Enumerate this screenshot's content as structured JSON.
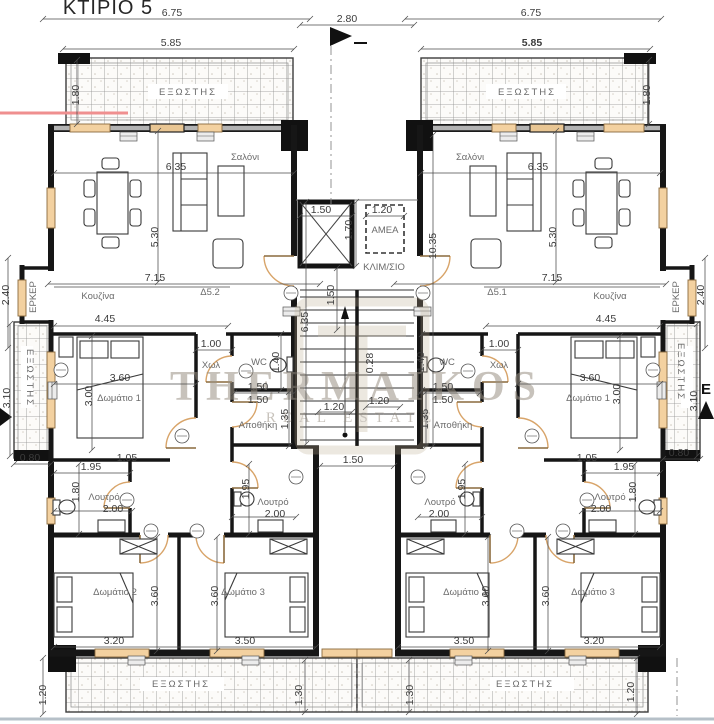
{
  "title": "ΚΤΙΡΙΟ 5",
  "watermark": {
    "name": "THERMAIKOS",
    "tagline": "REAL ESTATE"
  },
  "colors": {
    "wall": "#161616",
    "window": "#f3d1a0",
    "door_arc": "#d8a469",
    "hatch_line": "#8f8f8f",
    "watermark": "#9a9184",
    "red_line": "#ef8f8f",
    "dim_text": "#3c3c3c",
    "room_text": "#6b6b6b"
  },
  "labels": [
    {
      "t": "ΚΤΙΡΙΟ 5",
      "x": 108,
      "y": 14,
      "k": "t"
    },
    {
      "t": "6.75",
      "x": 172,
      "y": 16,
      "k": "d"
    },
    {
      "t": "2.80",
      "x": 347,
      "y": 22,
      "k": "d"
    },
    {
      "t": "6.75",
      "x": 531,
      "y": 16,
      "k": "d"
    },
    {
      "t": "5.85",
      "x": 171,
      "y": 46,
      "k": "d"
    },
    {
      "t": "5.85",
      "x": 532,
      "y": 46,
      "k": "d",
      "b": 1
    },
    {
      "t": "ΕΞΩΣΤΗΣ",
      "x": 188,
      "y": 95,
      "k": "r",
      "ls": 2
    },
    {
      "t": "ΕΞΩΣΤΗΣ",
      "x": 527,
      "y": 95,
      "k": "r",
      "ls": 2
    },
    {
      "t": "1.80",
      "x": 79,
      "y": 95,
      "k": "d",
      "r": -90
    },
    {
      "t": "1.80",
      "x": 650,
      "y": 95,
      "k": "d",
      "r": -90
    },
    {
      "t": "Σαλόνι",
      "x": 245,
      "y": 160,
      "k": "r"
    },
    {
      "t": "Σαλόνι",
      "x": 470,
      "y": 160,
      "k": "r"
    },
    {
      "t": "6.35",
      "x": 176,
      "y": 170,
      "k": "d"
    },
    {
      "t": "6.35",
      "x": 538,
      "y": 170,
      "k": "d"
    },
    {
      "t": "5.30",
      "x": 158,
      "y": 237,
      "k": "d",
      "r": -90
    },
    {
      "t": "5.30",
      "x": 556,
      "y": 237,
      "k": "d",
      "r": -90
    },
    {
      "t": "1.50",
      "x": 321,
      "y": 213,
      "k": "d"
    },
    {
      "t": "1.70",
      "x": 352,
      "y": 230,
      "k": "d",
      "r": -90
    },
    {
      "t": "1.20",
      "x": 382,
      "y": 213,
      "k": "d"
    },
    {
      "t": "ΑΜΕΑ",
      "x": 385,
      "y": 233,
      "k": "r",
      "s": 9
    },
    {
      "t": "ΚΛΙΜ/ΣΙΟ",
      "x": 384,
      "y": 270,
      "k": "r",
      "s": 9
    },
    {
      "t": "10.35",
      "x": 436,
      "y": 246,
      "k": "d",
      "r": -90
    },
    {
      "t": "6.35",
      "x": 308,
      "y": 322,
      "k": "d",
      "r": -90
    },
    {
      "t": "1.50",
      "x": 334,
      "y": 295,
      "k": "d",
      "r": -90
    },
    {
      "t": "0.28",
      "x": 373,
      "y": 363,
      "k": "d",
      "r": -90
    },
    {
      "t": "7.15",
      "x": 155,
      "y": 281,
      "k": "d"
    },
    {
      "t": "7.15",
      "x": 552,
      "y": 281,
      "k": "d"
    },
    {
      "t": "Κουζίνα",
      "x": 98,
      "y": 299,
      "k": "r"
    },
    {
      "t": "Κουζίνα",
      "x": 610,
      "y": 299,
      "k": "r"
    },
    {
      "t": "Δ5.2",
      "x": 210,
      "y": 295,
      "k": "r"
    },
    {
      "t": "Δ5.1",
      "x": 497,
      "y": 295,
      "k": "r"
    },
    {
      "t": "ΕΡΚΕΡ",
      "x": 36,
      "y": 297,
      "k": "r",
      "r": -90,
      "s": 9
    },
    {
      "t": "ΕΡΚΕΡ",
      "x": 679,
      "y": 297,
      "k": "r",
      "r": -90,
      "s": 9
    },
    {
      "t": "2.40",
      "x": 9,
      "y": 295,
      "k": "d",
      "r": -90
    },
    {
      "t": "2.40",
      "x": 704,
      "y": 295,
      "k": "d",
      "r": -90
    },
    {
      "t": "4.45",
      "x": 105,
      "y": 322,
      "k": "d"
    },
    {
      "t": "4.45",
      "x": 606,
      "y": 322,
      "k": "d"
    },
    {
      "t": "1.00",
      "x": 211,
      "y": 347,
      "k": "d"
    },
    {
      "t": "1.00",
      "x": 499,
      "y": 347,
      "k": "d"
    },
    {
      "t": "Χωλ",
      "x": 211,
      "y": 368,
      "k": "r"
    },
    {
      "t": "Χωλ",
      "x": 499,
      "y": 368,
      "k": "r"
    },
    {
      "t": "WC",
      "x": 259,
      "y": 365,
      "k": "r",
      "s": 9
    },
    {
      "t": "WC",
      "x": 447,
      "y": 365,
      "k": "r",
      "s": 9
    },
    {
      "t": "1.40",
      "x": 279,
      "y": 362,
      "k": "d",
      "r": -90
    },
    {
      "t": "1.40",
      "x": 424,
      "y": 362,
      "k": "d",
      "r": -90
    },
    {
      "t": "3.60",
      "x": 120,
      "y": 381,
      "k": "d"
    },
    {
      "t": "3.60",
      "x": 590,
      "y": 381,
      "k": "d"
    },
    {
      "t": "Δωμάτιο 1",
      "x": 119,
      "y": 401,
      "k": "r"
    },
    {
      "t": "Δωμάτιο 1",
      "x": 588,
      "y": 401,
      "k": "r"
    },
    {
      "t": "3.00",
      "x": 92,
      "y": 396,
      "k": "d",
      "r": -90
    },
    {
      "t": "3.00",
      "x": 620,
      "y": 394,
      "k": "d",
      "r": -90
    },
    {
      "t": "1.50",
      "x": 258,
      "y": 390,
      "k": "d"
    },
    {
      "t": "1.50",
      "x": 258,
      "y": 403,
      "k": "d"
    },
    {
      "t": "1.50",
      "x": 443,
      "y": 390,
      "k": "d"
    },
    {
      "t": "1.50",
      "x": 443,
      "y": 403,
      "k": "d"
    },
    {
      "t": "Αποθήκη",
      "x": 258,
      "y": 428,
      "k": "r",
      "s": 8.5
    },
    {
      "t": "Αποθήκη",
      "x": 453,
      "y": 428,
      "k": "r",
      "s": 8.5
    },
    {
      "t": "1.35",
      "x": 288,
      "y": 419,
      "k": "d",
      "r": -90
    },
    {
      "t": "1.35",
      "x": 428,
      "y": 419,
      "k": "d",
      "r": -90
    },
    {
      "t": "1.20",
      "x": 334,
      "y": 410,
      "k": "d"
    },
    {
      "t": "1.20",
      "x": 379,
      "y": 404,
      "k": "d"
    },
    {
      "t": "ΕΞΩΣΤΗΣ",
      "x": 27,
      "y": 378,
      "k": "r",
      "r": 90,
      "s": 8.5,
      "ls": 2
    },
    {
      "t": "ΕΞΩΣΤΗΣ",
      "x": 678,
      "y": 372,
      "k": "r",
      "r": 90,
      "s": 8.5,
      "ls": 2
    },
    {
      "t": "3.10",
      "x": 10,
      "y": 398,
      "k": "d",
      "r": -90
    },
    {
      "t": "3.10",
      "x": 697,
      "y": 401,
      "k": "d",
      "r": -90
    },
    {
      "t": "0.80",
      "x": 30,
      "y": 461,
      "k": "d"
    },
    {
      "t": "0.80",
      "x": 679,
      "y": 456,
      "k": "d"
    },
    {
      "t": "1.05",
      "x": 127,
      "y": 461,
      "k": "d"
    },
    {
      "t": "1.05",
      "x": 587,
      "y": 461,
      "k": "d"
    },
    {
      "t": "1.50",
      "x": 353,
      "y": 463,
      "k": "d"
    },
    {
      "t": "1.95",
      "x": 91,
      "y": 470,
      "k": "d"
    },
    {
      "t": "1.95",
      "x": 624,
      "y": 470,
      "k": "d"
    },
    {
      "t": "1.80",
      "x": 79,
      "y": 492,
      "k": "d",
      "r": -90
    },
    {
      "t": "1.80",
      "x": 636,
      "y": 492,
      "k": "d",
      "r": -90
    },
    {
      "t": "Λουτρό",
      "x": 104,
      "y": 500,
      "k": "r"
    },
    {
      "t": "Λουτρό",
      "x": 273,
      "y": 505,
      "k": "r"
    },
    {
      "t": "Λουτρό",
      "x": 440,
      "y": 505,
      "k": "r"
    },
    {
      "t": "Λουτρό",
      "x": 610,
      "y": 500,
      "k": "r"
    },
    {
      "t": "2.00",
      "x": 113,
      "y": 512,
      "k": "d"
    },
    {
      "t": "2.00",
      "x": 275,
      "y": 517,
      "k": "d"
    },
    {
      "t": "2.00",
      "x": 439,
      "y": 517,
      "k": "d"
    },
    {
      "t": "2.00",
      "x": 601,
      "y": 512,
      "k": "d"
    },
    {
      "t": "1.95",
      "x": 249,
      "y": 489,
      "k": "d",
      "r": -90
    },
    {
      "t": "1.95",
      "x": 465,
      "y": 489,
      "k": "d",
      "r": -90
    },
    {
      "t": "Δωμάτιο 2",
      "x": 115,
      "y": 595,
      "k": "r"
    },
    {
      "t": "3.60",
      "x": 158,
      "y": 596,
      "k": "d",
      "r": -90
    },
    {
      "t": "3.20",
      "x": 114,
      "y": 644,
      "k": "d"
    },
    {
      "t": "Δωμάτιο 3",
      "x": 243,
      "y": 595,
      "k": "r"
    },
    {
      "t": "3.60",
      "x": 218,
      "y": 596,
      "k": "d",
      "r": -90
    },
    {
      "t": "3.50",
      "x": 245,
      "y": 644,
      "k": "d"
    },
    {
      "t": "Δωμάτιο 2",
      "x": 465,
      "y": 595,
      "k": "r"
    },
    {
      "t": "3.60",
      "x": 489,
      "y": 596,
      "k": "d",
      "r": -90
    },
    {
      "t": "3.50",
      "x": 464,
      "y": 644,
      "k": "d"
    },
    {
      "t": "Δωμάτιο 3",
      "x": 593,
      "y": 595,
      "k": "r"
    },
    {
      "t": "3.60",
      "x": 549,
      "y": 596,
      "k": "d",
      "r": -90
    },
    {
      "t": "3.20",
      "x": 594,
      "y": 644,
      "k": "d"
    },
    {
      "t": "ΕΞΩΣΤΗΣ",
      "x": 181,
      "y": 687,
      "k": "r",
      "ls": 2
    },
    {
      "t": "ΕΞΩΣΤΗΣ",
      "x": 525,
      "y": 687,
      "k": "r",
      "ls": 2
    },
    {
      "t": "1.20",
      "x": 46,
      "y": 695,
      "k": "d",
      "r": -90
    },
    {
      "t": "1.30",
      "x": 302,
      "y": 695,
      "k": "d",
      "r": -90
    },
    {
      "t": "1.30",
      "x": 413,
      "y": 695,
      "k": "d",
      "r": -90
    },
    {
      "t": "1.20",
      "x": 634,
      "y": 692,
      "k": "d",
      "r": -90
    },
    {
      "t": "E",
      "x": 706,
      "y": 394,
      "k": "m"
    }
  ],
  "dim_lines": [
    [
      43,
      19,
      310,
      19
    ],
    [
      300,
      25,
      414,
      25
    ],
    [
      405,
      19,
      661,
      19
    ],
    [
      63,
      49,
      294,
      49
    ],
    [
      421,
      49,
      650,
      49
    ],
    [
      77,
      60,
      77,
      124
    ],
    [
      649,
      60,
      649,
      124
    ],
    [
      54,
      173,
      294,
      173
    ],
    [
      421,
      173,
      660,
      173
    ],
    [
      158,
      131,
      158,
      282
    ],
    [
      556,
      131,
      556,
      282
    ],
    [
      300,
      216,
      352,
      216
    ],
    [
      366,
      216,
      404,
      216
    ],
    [
      356,
      202,
      356,
      266
    ],
    [
      306,
      202,
      306,
      444
    ],
    [
      337,
      268,
      337,
      330
    ],
    [
      433,
      135,
      433,
      446
    ],
    [
      48,
      284,
      320,
      284
    ],
    [
      394,
      284,
      666,
      284
    ],
    [
      8,
      258,
      8,
      348
    ],
    [
      705,
      258,
      705,
      348
    ],
    [
      54,
      326,
      228,
      326
    ],
    [
      486,
      326,
      660,
      326
    ],
    [
      196,
      350,
      232,
      350
    ],
    [
      482,
      350,
      518,
      350
    ],
    [
      54,
      384,
      196,
      384
    ],
    [
      518,
      384,
      660,
      384
    ],
    [
      92,
      336,
      92,
      450
    ],
    [
      620,
      336,
      620,
      450
    ],
    [
      281,
      334,
      281,
      390
    ],
    [
      422,
      334,
      422,
      390
    ],
    [
      234,
      393,
      294,
      393
    ],
    [
      420,
      393,
      480,
      393
    ],
    [
      289,
      392,
      289,
      446
    ],
    [
      426,
      392,
      426,
      446
    ],
    [
      318,
      412,
      352,
      412
    ],
    [
      366,
      407,
      400,
      407
    ],
    [
      10,
      324,
      10,
      456
    ],
    [
      697,
      324,
      697,
      456
    ],
    [
      14,
      464,
      51,
      464
    ],
    [
      663,
      459,
      700,
      459
    ],
    [
      320,
      466,
      394,
      466
    ],
    [
      54,
      473,
      130,
      473
    ],
    [
      584,
      473,
      660,
      473
    ],
    [
      79,
      464,
      79,
      534
    ],
    [
      635,
      464,
      635,
      534
    ],
    [
      54,
      511,
      132,
      511
    ],
    [
      582,
      511,
      660,
      511
    ],
    [
      232,
      517,
      296,
      517
    ],
    [
      418,
      517,
      482,
      517
    ],
    [
      249,
      464,
      249,
      534
    ],
    [
      465,
      464,
      465,
      534
    ],
    [
      157,
      537,
      157,
      651
    ],
    [
      217,
      537,
      217,
      651
    ],
    [
      488,
      537,
      488,
      651
    ],
    [
      548,
      537,
      548,
      651
    ],
    [
      54,
      647,
      316,
      647
    ],
    [
      398,
      647,
      660,
      647
    ],
    [
      305,
      660,
      305,
      712
    ],
    [
      409,
      660,
      409,
      712
    ],
    [
      43,
      658,
      43,
      714
    ],
    [
      637,
      658,
      637,
      714
    ]
  ]
}
